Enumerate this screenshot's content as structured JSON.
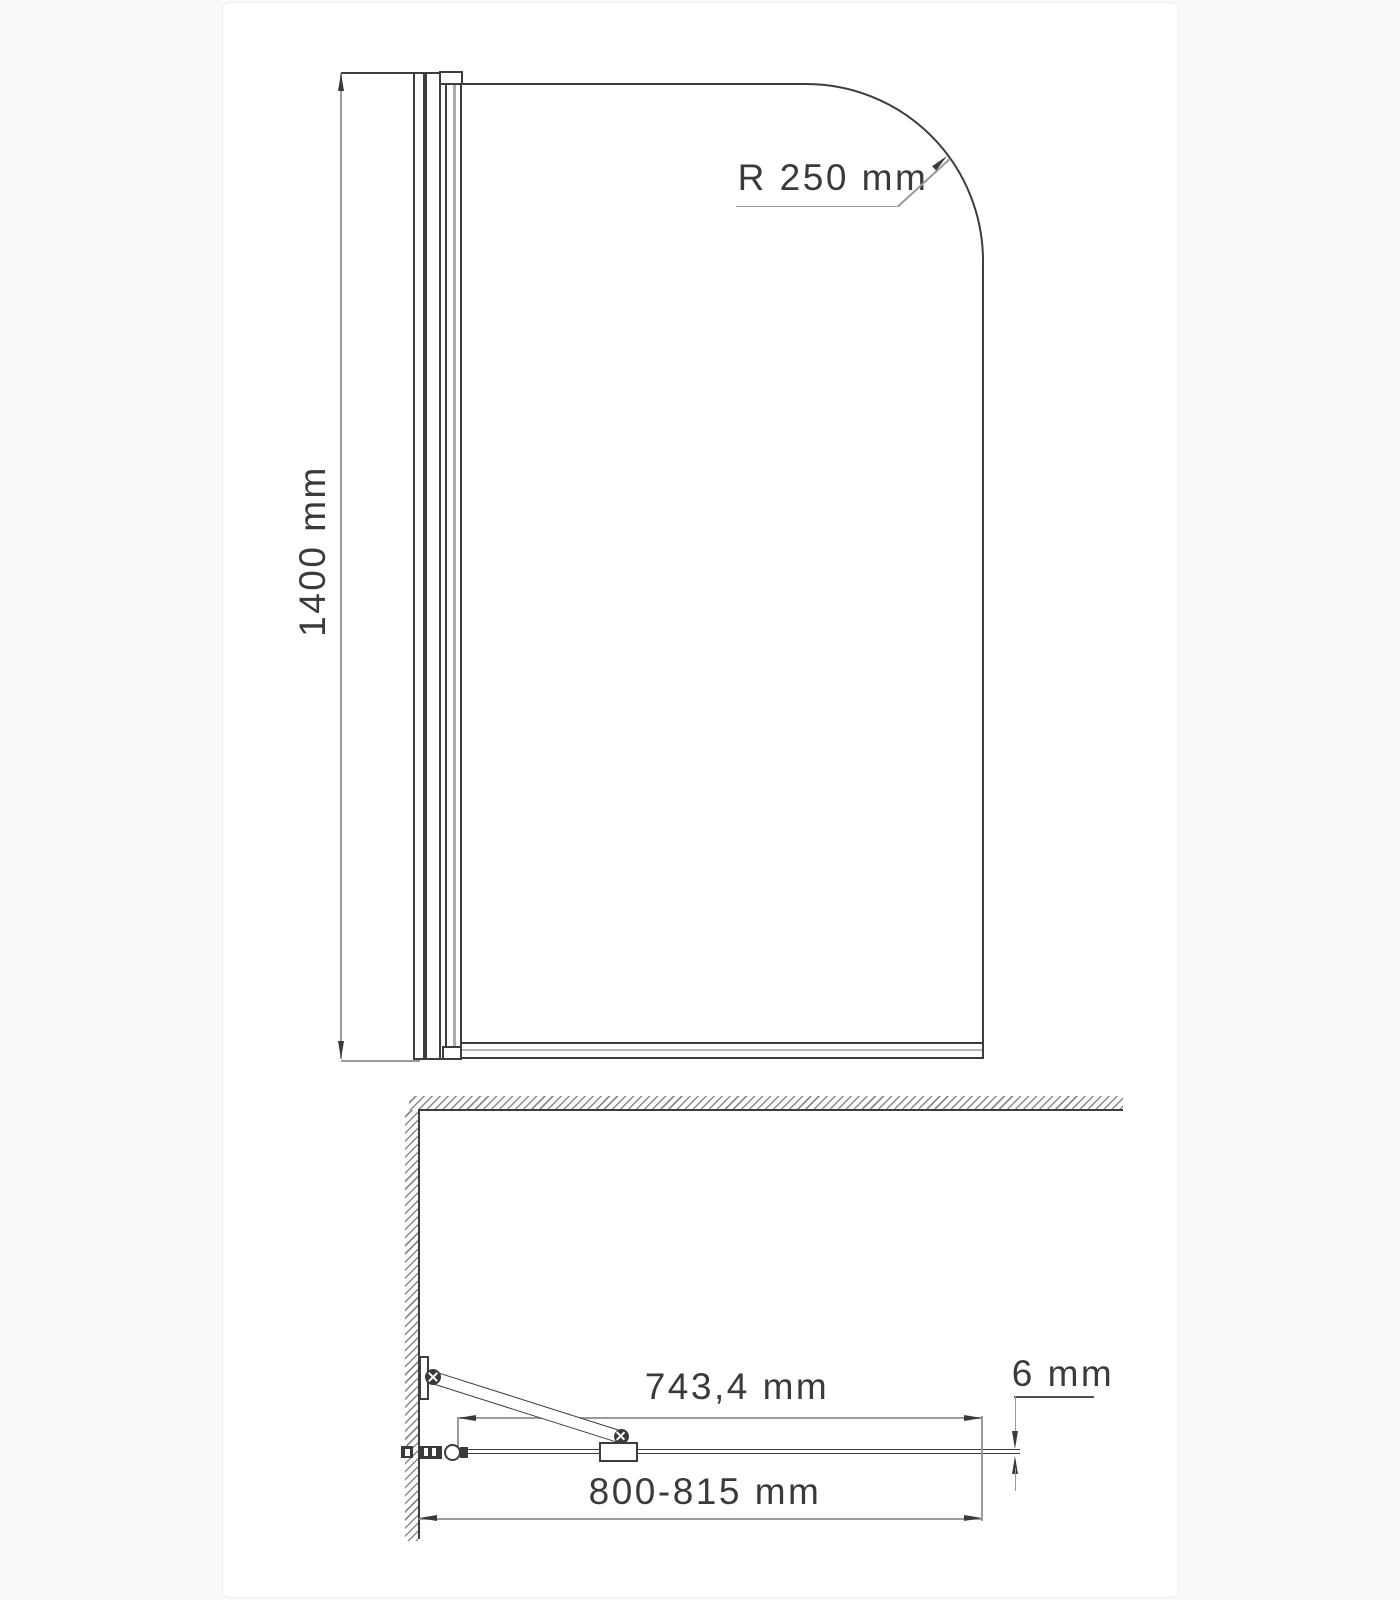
{
  "drawing": {
    "type": "technical-dimension-diagram",
    "subject": "bath screen glass panel, front view and top (plan) view",
    "colors": {
      "outline": "#3d3d3d",
      "dimension_line": "#9a9a9a",
      "text": "#3a3a3a",
      "hatch": "#8a8a8a",
      "seal_strip": "#b8b8b8",
      "card_background": "#ffffff",
      "page_background": "#fafafa"
    },
    "front_view": {
      "height_label": "1400 mm",
      "corner_radius_label": "R 250 mm"
    },
    "plan_view": {
      "pivot_to_edge_label": "743,4 mm",
      "total_width_label": "800-815 mm",
      "glass_thickness_label": "6 mm"
    }
  }
}
